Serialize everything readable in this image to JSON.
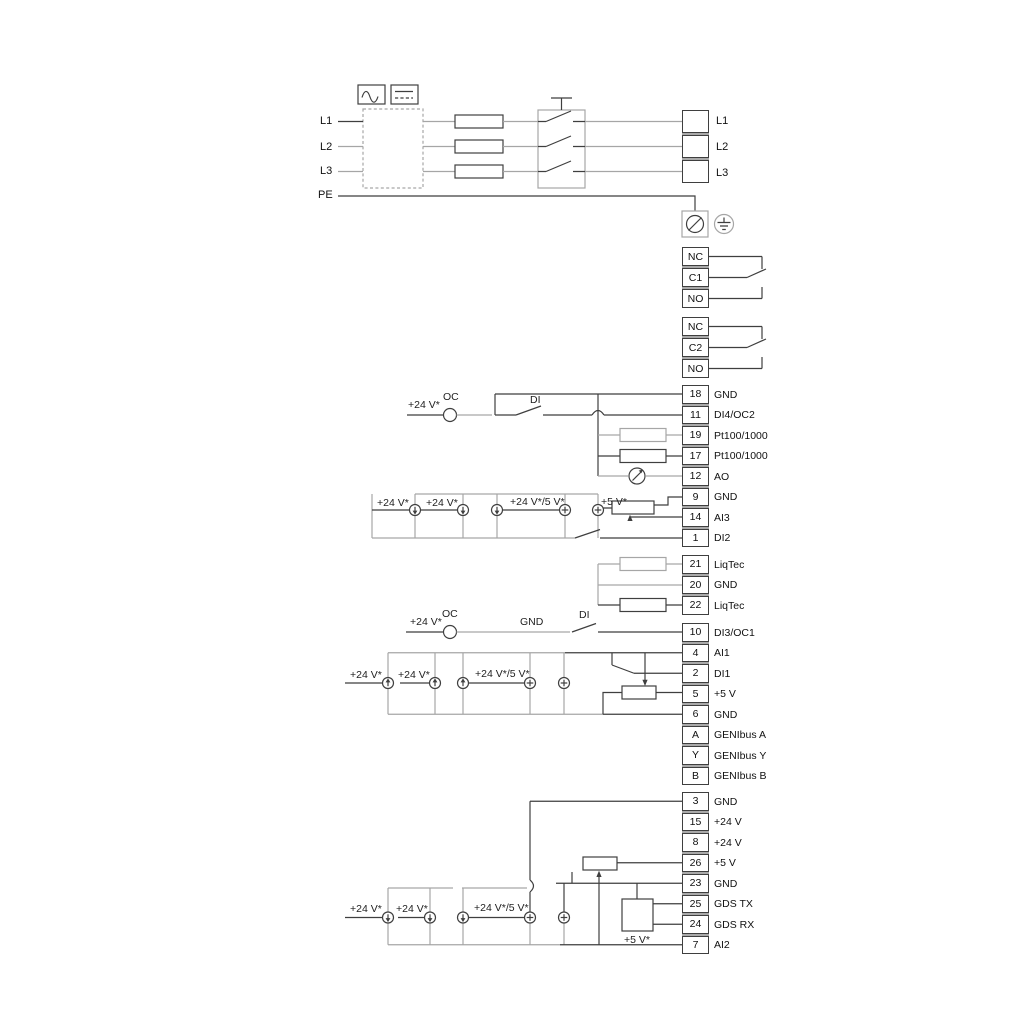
{
  "colors": {
    "background": "#ffffff",
    "wire_dark": "#3f3f3f",
    "wire_gray": "#a6a6a6",
    "text": "#111111",
    "terminal_fill": "#ffffff"
  },
  "power": {
    "left_labels": [
      "L1",
      "L2",
      "L3",
      "PE"
    ],
    "right_labels": [
      "L1",
      "L2",
      "L3"
    ]
  },
  "relay1": {
    "rows": [
      "NC",
      "C1",
      "NO"
    ]
  },
  "relay2": {
    "rows": [
      "NC",
      "C2",
      "NO"
    ]
  },
  "strip1": {
    "rows": [
      {
        "num": "18",
        "label": "GND"
      },
      {
        "num": "11",
        "label": "DI4/OC2"
      },
      {
        "num": "19",
        "label": "Pt100/1000"
      },
      {
        "num": "17",
        "label": "Pt100/1000"
      },
      {
        "num": "12",
        "label": "AO"
      },
      {
        "num": "9",
        "label": "GND"
      },
      {
        "num": "14",
        "label": "AI3"
      },
      {
        "num": "1",
        "label": "DI2"
      }
    ]
  },
  "strip2": {
    "rows": [
      {
        "num": "21",
        "label": "LiqTec"
      },
      {
        "num": "20",
        "label": "GND"
      },
      {
        "num": "22",
        "label": "LiqTec"
      }
    ]
  },
  "strip3": {
    "rows": [
      {
        "num": "10",
        "label": "DI3/OC1"
      },
      {
        "num": "4",
        "label": "AI1"
      },
      {
        "num": "2",
        "label": "DI1"
      },
      {
        "num": "5",
        "label": "+5 V"
      },
      {
        "num": "6",
        "label": "GND"
      },
      {
        "num": "A",
        "label": "GENIbus A"
      },
      {
        "num": "Y",
        "label": "GENIbus Y"
      },
      {
        "num": "B",
        "label": "GENIbus B"
      }
    ]
  },
  "strip4": {
    "rows": [
      {
        "num": "3",
        "label": "GND"
      },
      {
        "num": "15",
        "label": "+24 V"
      },
      {
        "num": "8",
        "label": "+24 V"
      },
      {
        "num": "26",
        "label": "+5 V"
      },
      {
        "num": "23",
        "label": "GND"
      },
      {
        "num": "25",
        "label": "GDS TX"
      },
      {
        "num": "24",
        "label": "GDS RX"
      },
      {
        "num": "7",
        "label": "AI2"
      }
    ]
  },
  "wire_labels": {
    "v24": "+24 V*",
    "v24v5": "+24 V*/5 V*",
    "v5": "+5 V*",
    "oc": "OC",
    "di": "DI",
    "gnd": "GND"
  }
}
